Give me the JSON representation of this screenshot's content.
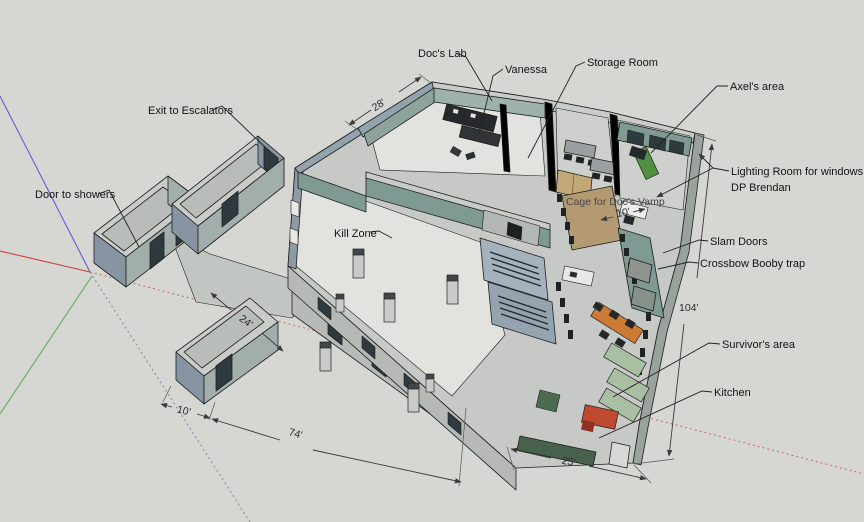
{
  "viewport": {
    "app": "3D model viewport",
    "description": "Perspective view of a survival-base floor plan with annotated rooms and dimensions",
    "background": "#d6d6d2"
  },
  "colors": {
    "background": "#d6d6d2",
    "axis_red": "#cf4037",
    "axis_red_dotted": "#cf6a5f",
    "axis_green": "#5fae5f",
    "axis_blue": "#5f5fd3",
    "axis_blue_dotted": "#8585ad",
    "wall_top": "#c9ccc8",
    "wall_blue": "#8795a3",
    "wall_teal": "#7e9a93",
    "floor_light": "#e2e2de",
    "bed_green": "#4f9140",
    "couch_green": "#a9bfa2",
    "table_orange": "#cd7a36",
    "stove_red": "#c04a30",
    "counter_green": "#47624c",
    "cage_tan": "#b49a72"
  },
  "labels": {
    "docs_lab": "Doc's Lab",
    "vanessa": "Vanessa",
    "storage_room": "Storage Room",
    "axels_area": "Axel's area",
    "lighting_room_line1": "Lighting Room for windows",
    "lighting_room_line2": "DP Brendan",
    "cage": "Cage for Doc's Vamp",
    "slam_doors": "Slam Doors",
    "crossbow": "Crossbow Booby trap",
    "survivors_area": "Survivor's area",
    "kitchen": "Kitchen",
    "exit_to_escalators": "Exit to Escalators",
    "door_to_showers": "Door to showers",
    "kill_zone": "Kill Zone"
  },
  "dimensions": {
    "lab_width": "28'",
    "cage_width": "10'",
    "corridor_width": "24'",
    "stub_width": "10'",
    "front_length": "74'",
    "kitchen_width": "25'",
    "side_length": "104'"
  }
}
